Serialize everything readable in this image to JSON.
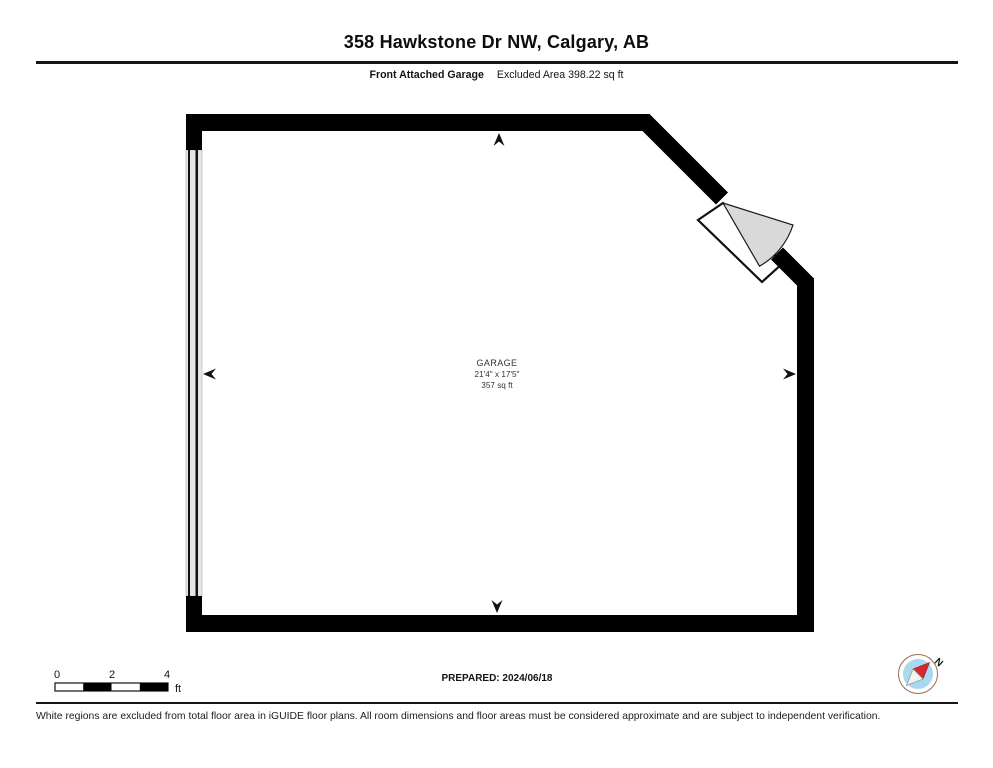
{
  "header": {
    "title": "358 Hawkstone Dr NW, Calgary, AB",
    "floor_label": "Front Attached Garage",
    "excluded_area_label": "Excluded Area 398.22 sq ft"
  },
  "floorplan": {
    "room": {
      "name": "GARAGE",
      "dimensions": "21'4\" x 17'5\"",
      "area": "357 sq ft"
    },
    "colors": {
      "wall": "#000000",
      "garage_door_fill": "#e6e6e6",
      "door_swing_fill": "#d9d9d9"
    }
  },
  "scale_bar": {
    "ticks": [
      "0",
      "2",
      "4"
    ],
    "unit": "ft"
  },
  "prepared": {
    "label": "PREPARED: 2024/06/18"
  },
  "compass": {
    "north_label": "N",
    "needle_color": "#d7282f",
    "disc_color": "#a9d9ef"
  },
  "footer": {
    "disclaimer": "White regions are excluded from total floor area in iGUIDE floor plans. All room dimensions and floor areas must be considered approximate and are subject to independent verification."
  }
}
